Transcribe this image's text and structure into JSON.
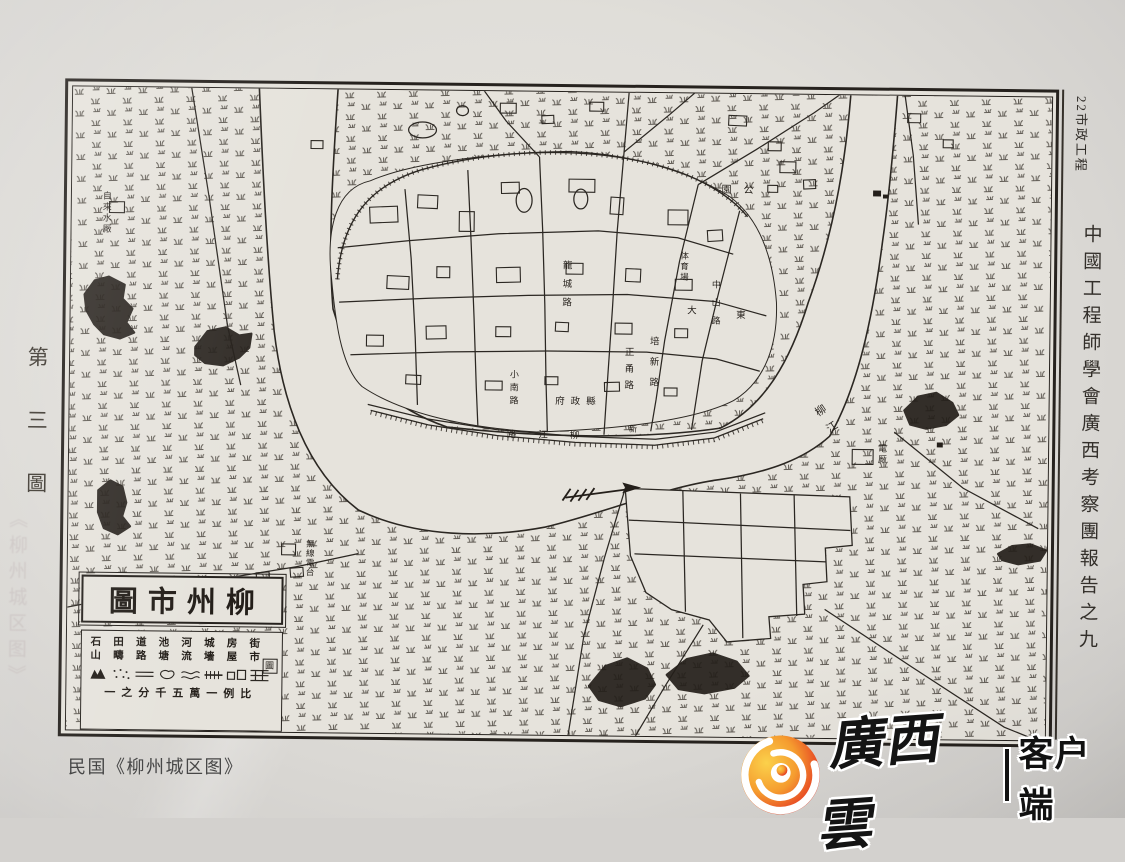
{
  "page": {
    "header_right": "22市政工程",
    "spine_text": "中國工程師學會廣西考察團報告之九",
    "figure_label": "第三圖",
    "faint_watermark": "《柳州城区图》",
    "caption": "民国《柳州城区图》",
    "logo": {
      "brand": "廣西雲",
      "client": "客户端",
      "icon": "swirl-flame-icon",
      "color_outer": "#f5a62c",
      "color_inner": "#dd2521"
    }
  },
  "map": {
    "ink": "#2b2722",
    "cartouche": {
      "title": "圖市州柳",
      "legend_items": [
        "街市",
        "房屋",
        "城墻",
        "河流",
        "池塘",
        "道路",
        "田疇",
        "石山"
      ],
      "legend_symbols": [
        "street-grid-symbol",
        "houses-symbol",
        "wall-hatch-symbol",
        "river-lines-symbol",
        "pond-symbol",
        "road-lines-symbol",
        "field-dots-symbol",
        "hill-symbol"
      ],
      "seal": "圖",
      "scale_text": "一之分千五萬一例比"
    },
    "labels": [
      {
        "t": "自來水厰",
        "x": 30,
        "y": 104,
        "v": 1,
        "s": 9,
        "ls": 2
      },
      {
        "t": "園公",
        "x": 650,
        "y": 92,
        "v": 0,
        "s": 10,
        "ls": 12
      },
      {
        "t": "電厰",
        "x": 808,
        "y": 348,
        "v": 1,
        "s": 9,
        "ls": 2
      },
      {
        "t": "無線電台",
        "x": 238,
        "y": 450,
        "v": 1,
        "s": 8.5,
        "ls": 1
      },
      {
        "t": "府政縣",
        "x": 486,
        "y": 306,
        "v": 0,
        "s": 9.5,
        "ls": 6
      },
      {
        "t": "龍城路",
        "x": 489,
        "y": 168,
        "v": 1,
        "s": 9.5,
        "ls": 9
      },
      {
        "t": "小南路",
        "x": 439,
        "y": 278,
        "v": 1,
        "s": 9,
        "ls": 4
      },
      {
        "t": "路江柳",
        "x": 438,
        "y": 340,
        "v": 0,
        "s": 9.5,
        "ls": 22
      },
      {
        "t": "培新路",
        "x": 577,
        "y": 243,
        "v": 1,
        "s": 9.5,
        "ls": 11
      },
      {
        "t": "正甬路",
        "x": 552,
        "y": 254,
        "v": 1,
        "s": 9.5,
        "ls": 7
      },
      {
        "t": "体育場",
        "x": 609,
        "y": 158,
        "v": 1,
        "s": 8.5,
        "ls": 2
      },
      {
        "t": "中山路",
        "x": 640,
        "y": 186,
        "v": 1,
        "s": 9,
        "ls": 9
      },
      {
        "t": "東",
        "x": 666,
        "y": 218,
        "v": 0,
        "s": 9.5,
        "ls": 0
      },
      {
        "t": "大",
        "x": 617,
        "y": 214,
        "v": 0,
        "s": 9.5,
        "ls": 0
      },
      {
        "t": "柳江",
        "x": 752,
        "y": 308,
        "v": 1,
        "s": 11,
        "ls": 9,
        "r": -35
      },
      {
        "t": "新",
        "x": 560,
        "y": 332,
        "v": 0,
        "s": 8.5,
        "ls": 0
      }
    ],
    "geometry": {
      "water": "M187,-8 C192,90 197,170 205,245 C214,315 238,385 292,425 C350,452 420,452 480,440 C540,425 600,398 655,390 C705,382 740,368 765,345 C793,295 807,225 816,148 C821,110 826,55 830,-8 L783,-8 C779,55 770,130 742,210 C725,268 700,315 655,338 C580,350 480,350 380,340 C320,320 282,282 264,222 C258,160 262,80 267,-8 Z",
      "city": "M262,190 C256,140 266,100 300,92 C340,74 420,62 500,60 C560,62 620,78 662,104 C692,126 706,165 710,210 C712,252 700,290 668,310 C630,330 560,340 470,344 C390,340 330,324 294,300 C272,280 266,230 262,190 Z",
      "wall": "M268,192 C272,128 302,96 352,80 C420,60 502,56 566,68 C622,78 660,100 680,124",
      "grid_outline": "M560,400 L786,406 L789,455 L762,458 L764,492 L740,495 L742,525 L706,528 L708,550 L664,554 L646,532 L608,522 L582,505 L566,468 Z",
      "grid_lines": [
        "M564,432 L787,440",
        "M570,466 L763,472",
        "M618,402 L622,524",
        "M676,404 L680,550",
        "M730,405 L734,527"
      ],
      "roads": [
        "M560,-8 L555,60 L549,140 L545,220 L541,290 L538,346",
        "M470,66 L474,140 L477,215 L479,290 L481,344",
        "M398,80 L402,150 L406,230 L409,300 L411,338",
        "M335,100 L342,170 L347,250 L350,318",
        "M268,160 L340,152 L430,144 L530,140 L610,146 L666,162",
        "M270,215 L360,210 L460,206 L560,204 L648,210 L700,224",
        "M282,268 L380,264 L480,262 L580,262 L650,268 L694,280",
        "M630,92 L612,170 L598,250 L590,310 L585,342",
        "M672,118 L652,200 L636,270 L626,340",
        "M300,318 L360,332 L430,342 L510,348 L590,350 L650,342 L700,322",
        "M303,324 L361,338 L430,348 L509,354 L589,356 L649,348 L698,328",
        "M470,66 L436,30 L408,-8",
        "M555,60 L600,22 L634,-8",
        "M630,92 L688,56 L746,18 L782,-8",
        "M118,-8 L138,110 L158,240 L172,300",
        "M-8,528 L60,514 L150,497 L230,483 L292,469",
        "M560,400 L540,470 L520,550 L505,652",
        "M640,537 L602,600 L572,652",
        "M762,520 L850,577 L944,637 L982,652",
        "M830,340 L900,396 L976,436",
        "M836,-8 L846,60 L852,130"
      ],
      "ticks": [
        "M268,192 C272,128 302,96 352,80 C420,60 502,56 566,68 C622,78 660,100 680,124",
        "M303,326 L361,340 L430,350 L509,356 L589,358 L649,350 L698,330"
      ],
      "hills": [
        "M14,210 l10,-14 l14,-4 l16,8 l-2,14 l10,10 l-6,14 l8,10 l-14,6 l-16,-4 l-10,-10 l-8,-14 z",
        "M126,262 l12,-16 l18,-4 l14,8 l12,-2 l-2,14 l-10,10 l-16,8 l-18,-2 l-10,-8 z",
        "M30,408 l12,-10 l12,6 l4,16 l-4,14 l8,10 l-12,8 l-14,-6 l-6,-16 z",
        "M840,318 l14,-14 l18,-4 l16,10 l6,12 l-12,10 l-20,4 l-16,-4 z",
        "M526,600 l16,-20 l22,-8 l20,10 l8,16 l-10,14 l-24,8 l-22,-6 z",
        "M604,588 l20,-16 l26,-6 l24,8 l12,14 l-14,12 l-30,6 l-26,-4 z",
        "M936,462 l14,-8 l18,-2 l16,6 l-6,10 l-22,4 l-16,-4 z"
      ],
      "blocks": [
        [
          300,
          118,
          28,
          16,
          -3
        ],
        [
          348,
          106,
          20,
          13,
          2
        ],
        [
          390,
          122,
          15,
          20,
          0
        ],
        [
          432,
          92,
          18,
          11,
          -2
        ],
        [
          500,
          88,
          26,
          13,
          0
        ],
        [
          542,
          106,
          13,
          17,
          3
        ],
        [
          600,
          118,
          20,
          15,
          0
        ],
        [
          640,
          138,
          15,
          11,
          -4
        ],
        [
          318,
          188,
          22,
          13,
          2
        ],
        [
          368,
          178,
          13,
          11,
          0
        ],
        [
          428,
          178,
          24,
          15,
          -2
        ],
        [
          498,
          173,
          17,
          11,
          0
        ],
        [
          558,
          178,
          15,
          13,
          2
        ],
        [
          608,
          188,
          17,
          11,
          0
        ],
        [
          298,
          248,
          17,
          11,
          0
        ],
        [
          358,
          238,
          20,
          13,
          -2
        ],
        [
          428,
          238,
          15,
          10,
          0
        ],
        [
          488,
          233,
          13,
          9,
          2
        ],
        [
          548,
          233,
          17,
          11,
          0
        ],
        [
          608,
          238,
          13,
          9,
          0
        ],
        [
          338,
          288,
          15,
          9,
          2
        ],
        [
          418,
          293,
          17,
          9,
          0
        ],
        [
          478,
          288,
          13,
          8,
          0
        ],
        [
          538,
          293,
          15,
          9,
          -2
        ],
        [
          598,
          298,
          13,
          8,
          0
        ],
        [
          430,
          12,
          16,
          10,
          0
        ],
        [
          472,
          24,
          12,
          8,
          -3
        ],
        [
          520,
          10,
          14,
          9,
          0
        ],
        [
          660,
          22,
          18,
          10,
          2
        ],
        [
          700,
          48,
          13,
          9,
          0
        ],
        [
          712,
          68,
          16,
          11,
          0
        ],
        [
          736,
          86,
          12,
          9,
          -3
        ],
        [
          700,
          92,
          10,
          7,
          0
        ],
        [
          38,
          116,
          15,
          11,
          0
        ],
        [
          788,
          358,
          21,
          15,
          0
        ],
        [
          215,
          460,
          14,
          11,
          0
        ],
        [
          20,
          514,
          13,
          9,
          -5
        ],
        [
          54,
          509,
          13,
          9,
          -5
        ],
        [
          88,
          504,
          13,
          9,
          -5
        ],
        [
          122,
          499,
          13,
          9,
          -5
        ],
        [
          156,
          494,
          13,
          9,
          -5
        ],
        [
          190,
          489,
          13,
          9,
          -5
        ],
        [
          224,
          484,
          13,
          9,
          -5
        ],
        [
          840,
          18,
          13,
          9,
          0
        ],
        [
          876,
          44,
          10,
          8,
          0
        ],
        [
          240,
          52,
          12,
          8,
          0
        ]
      ],
      "marks": [
        [
          806,
          96,
          8,
          6
        ],
        [
          816,
          100,
          5,
          4
        ],
        [
          873,
          350,
          6,
          5
        ]
      ],
      "ellipses": [
        [
          352,
          40,
          14,
          8
        ],
        [
          392,
          20,
          6,
          5
        ],
        [
          455,
          110,
          8,
          12
        ],
        [
          512,
          108,
          7,
          10
        ]
      ],
      "arrow": {
        "shaft": "M500,410 L562,401",
        "head": "M576,399 L557,394 L560,399.5 L557,405 Z",
        "tail": "M497,413 L505,401 M505,414 L513,402 M513,413 L521,401 M521,412 L529,400"
      }
    }
  }
}
